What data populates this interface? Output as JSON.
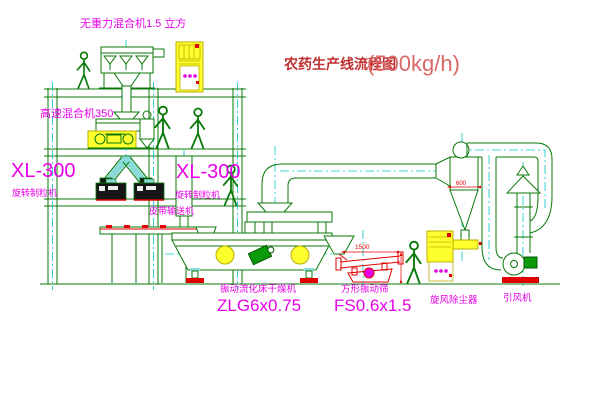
{
  "title": {
    "name": "农药生产线流程图",
    "capacity": "(500kg/h)"
  },
  "equipment": {
    "gravity_mixer": {
      "label": "无重力混合机1.5 立方"
    },
    "high_speed_mixer": {
      "label": "高速混合机350"
    },
    "granulator_left": {
      "model": "XL-300",
      "name": "旋转制粒机"
    },
    "granulator_right": {
      "model": "XL-300",
      "name": "旋转制粒机"
    },
    "belt_conveyor": {
      "label": "皮带输送机"
    },
    "fluid_bed_dryer": {
      "name": "振动流化床干燥机",
      "model": "ZLG6x0.75"
    },
    "vibrating_screen": {
      "name": "方形振动筛",
      "model": "FS0.6x1.5",
      "dim": "1500"
    },
    "cyclone": {
      "name": "旋风除尘器",
      "dim": "600"
    },
    "induced_draft_fan": {
      "name": "引风机"
    }
  },
  "colors": {
    "line_green": "#087808",
    "centerline_cyan": "#00c8c8",
    "label_magenta": "#e800e8",
    "dimension_red": "#e00000",
    "cabinet_yellow": "#ffff2e",
    "title_red": "#c03030",
    "title_capacity_red": "#d96868",
    "background": "#ffffff"
  }
}
